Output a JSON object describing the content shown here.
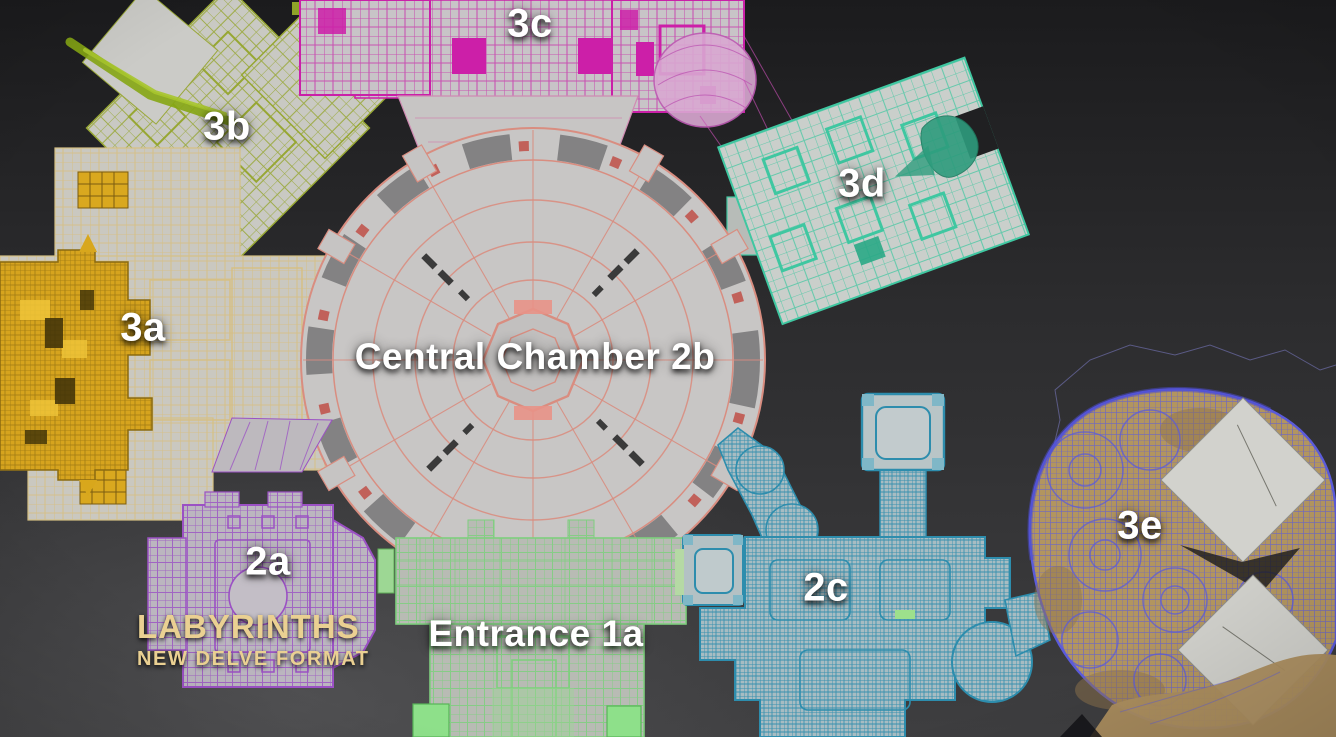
{
  "view": {
    "kind": "top-down wireframe dungeon layout",
    "background_top_color": "#1b1b1d",
    "background_bottom_color": "#3e3e40",
    "label_color": "#ffffff"
  },
  "branding": {
    "title": "LABYRINTHS",
    "subtitle": "NEW DELVE FORMAT",
    "text_color": "#ead092"
  },
  "map": {
    "zones": [
      {
        "id": "3b",
        "label": "3b",
        "wire_color": "#97a733"
      },
      {
        "id": "3c",
        "label": "3c",
        "wire_color": "#ca20a8"
      },
      {
        "id": "3d",
        "label": "3d",
        "wire_color": "#3fc7a1"
      },
      {
        "id": "3a",
        "label": "3a",
        "wire_color": "#d8a71c"
      },
      {
        "id": "2b",
        "label": "Central Chamber 2b",
        "wire_color": "#d98d80"
      },
      {
        "id": "2a",
        "label": "2a",
        "wire_color": "#9b51c4"
      },
      {
        "id": "1a",
        "label": "Entrance 1a",
        "wire_color": "#7fcf7f"
      },
      {
        "id": "2c",
        "label": "2c",
        "wire_color": "#2d8dad"
      },
      {
        "id": "3e",
        "label": "3e",
        "wire_color": "#5b5bdb"
      }
    ]
  }
}
